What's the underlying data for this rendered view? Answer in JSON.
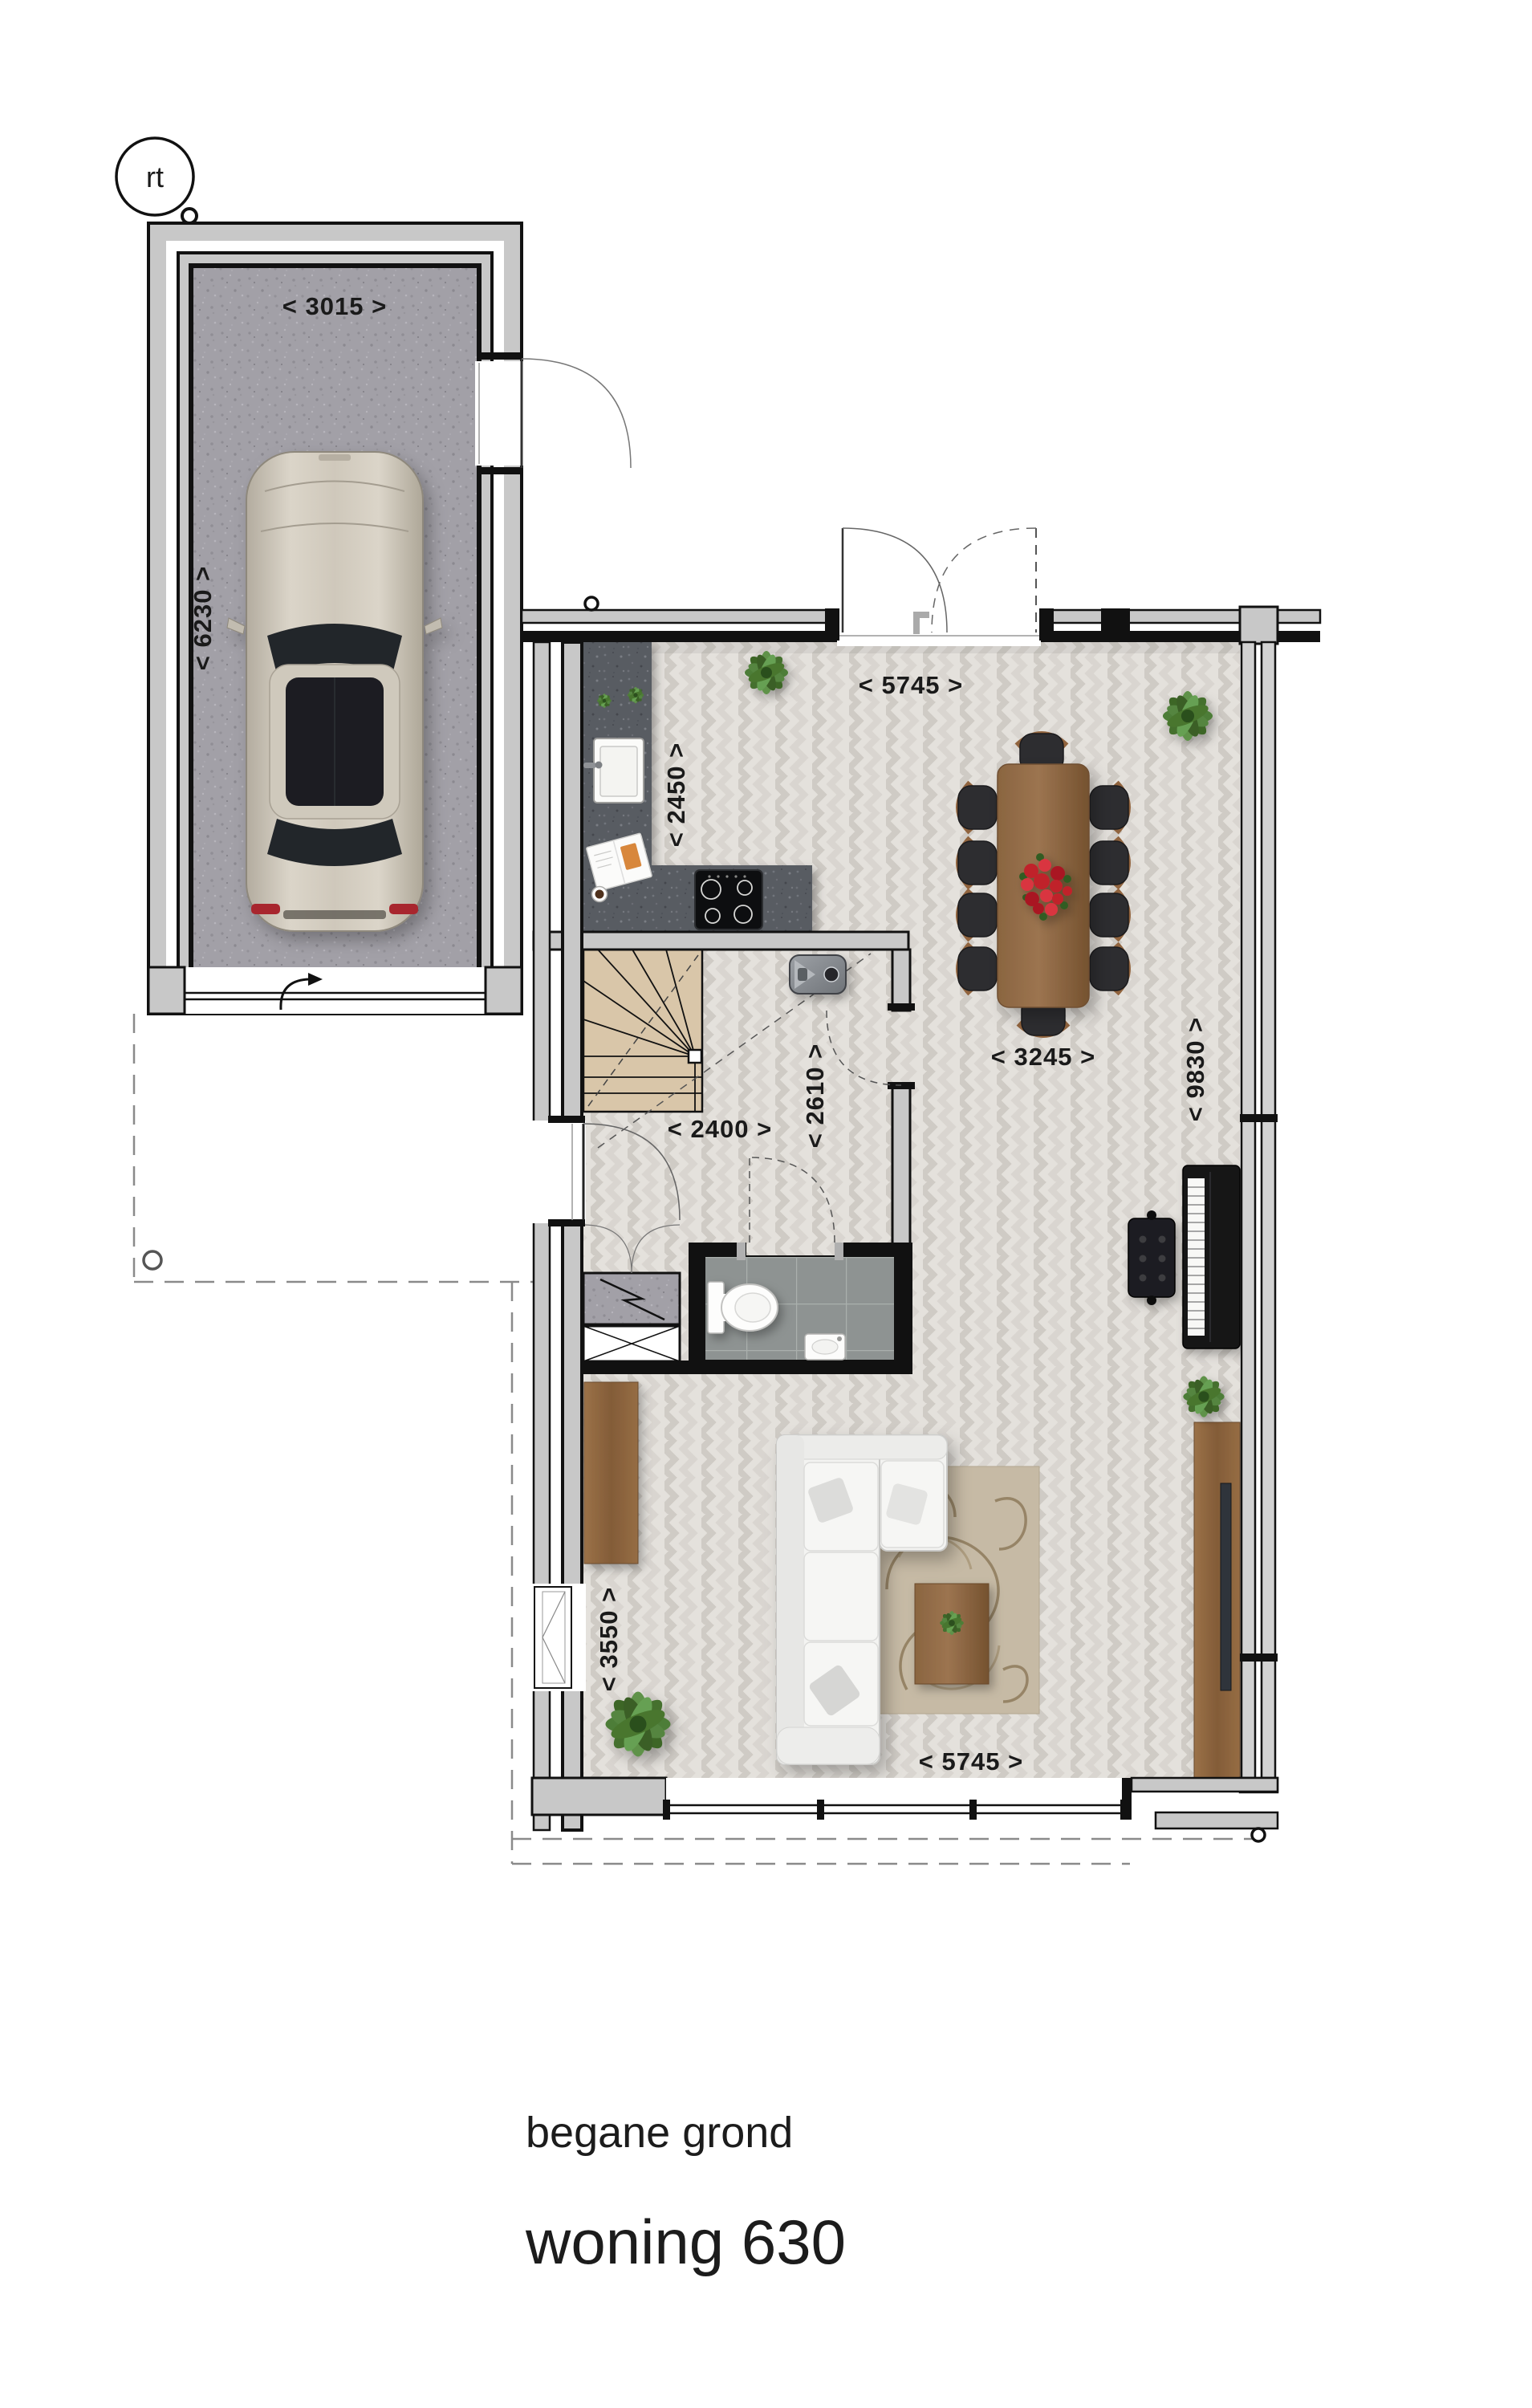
{
  "marker": {
    "label": "rt"
  },
  "titles": {
    "floor": "begane grond",
    "unit": "woning 630"
  },
  "dims": {
    "garage_width": "< 3015 >",
    "garage_depth": "< 6230 >",
    "room_width_top": "< 5745 >",
    "kitchen_depth": "< 2450 >",
    "hall_width": "< 2400 >",
    "hall_depth": "< 2610 >",
    "dining_width": "< 3245 >",
    "room_depth": "< 9830 >",
    "living_left_depth": "< 3550 >",
    "room_width_bottom": "< 5745 >"
  },
  "colors": {
    "wall_gray": "#c8c8c8",
    "wall_black": "#111111",
    "parquet_floor": "#e4e1dc",
    "garage_floor": "#a2a0a7",
    "counter_gray": "#595c62",
    "tile_gray": "#8e9392",
    "stair_tan": "#d9c6a9",
    "wood_furniture": "#96714a",
    "sofa_white": "#f3f3f1",
    "rug_beige": "#c6baa5",
    "plant_green": "#4e7d37",
    "flower_red": "#c0202a",
    "text_dark": "#1a1a1a"
  }
}
